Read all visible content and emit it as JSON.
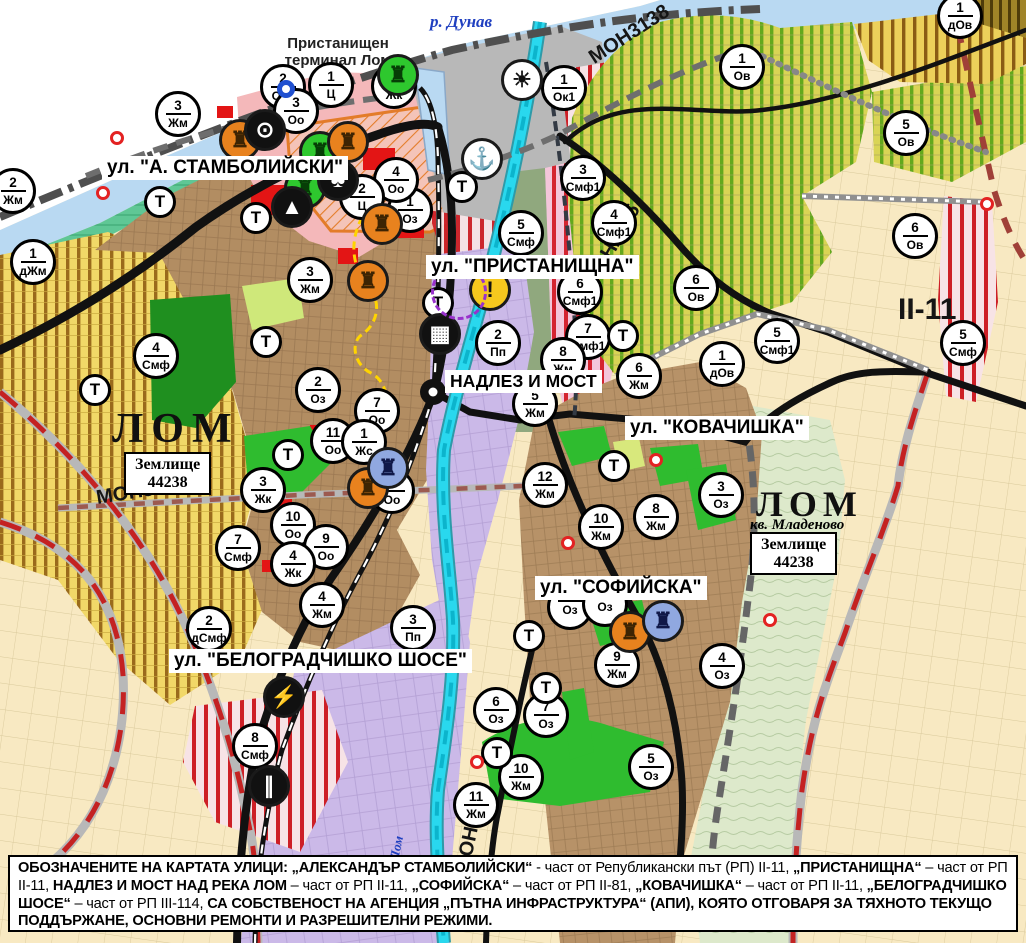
{
  "map": {
    "street_labels": [
      {
        "id": "stamboliyski",
        "text": "ул. \"А. СТАМБОЛИЙСКИ\""
      },
      {
        "id": "pristanishtna",
        "text": "ул. \"ПРИСТАНИЩНА\""
      },
      {
        "id": "nadlez",
        "text": "НАДЛЕЗ И МОСТ"
      },
      {
        "id": "kovachishka",
        "text": "ул. \"КОВАЧИШКА\""
      },
      {
        "id": "sofiyska",
        "text": "ул. \"СОФИЙСКА\""
      },
      {
        "id": "belogradchishko",
        "text": "ул. \"БЕЛОГРАДЧИШКО ШОСЕ\""
      }
    ],
    "place_labels": {
      "terminal": "Пристанищен терминал Лом",
      "danube": "р. Дунав",
      "lom_river": "Лом",
      "lom_left": "ЛОМ",
      "lom_right": "ЛОМ",
      "kv_mladenovo": "кв. Младеново",
      "zemlishte_line1": "Землище",
      "zemlishte_line2": "44238"
    },
    "road_labels": {
      "mon3139": "МОН3139",
      "mon3138": "МОН3138",
      "mon2135": "МОН2135",
      "mon2136": "МОН2136",
      "ii11": "II-11"
    },
    "t_label": "Т",
    "markers": [
      {
        "x": 283,
        "y": 87,
        "n": "2",
        "c": "Ози"
      },
      {
        "x": 331,
        "y": 85,
        "n": "1",
        "c": "Ц"
      },
      {
        "x": 296,
        "y": 111,
        "n": "3",
        "c": "Оо"
      },
      {
        "x": 394,
        "y": 86,
        "n": "1",
        "c": "Жк"
      },
      {
        "x": 178,
        "y": 114,
        "n": "3",
        "c": "Жм"
      },
      {
        "x": 13,
        "y": 191,
        "n": "2",
        "c": "Жм"
      },
      {
        "x": 33,
        "y": 262,
        "n": "1",
        "c": "дЖм"
      },
      {
        "x": 960,
        "y": 16,
        "n": "1",
        "c": "дОв"
      },
      {
        "x": 742,
        "y": 67,
        "n": "1",
        "c": "Ов"
      },
      {
        "x": 906,
        "y": 133,
        "n": "5",
        "c": "Ов"
      },
      {
        "x": 564,
        "y": 88,
        "n": "1",
        "c": "Ок1"
      },
      {
        "x": 583,
        "y": 178,
        "n": "3",
        "c": "Смф1"
      },
      {
        "x": 521,
        "y": 233,
        "n": "5",
        "c": "Смф"
      },
      {
        "x": 614,
        "y": 223,
        "n": "4",
        "c": "Смф1"
      },
      {
        "x": 410,
        "y": 210,
        "n": "1",
        "c": "Оз"
      },
      {
        "x": 396,
        "y": 180,
        "n": "4",
        "c": "Оо"
      },
      {
        "x": 362,
        "y": 197,
        "n": "2",
        "c": "Ц"
      },
      {
        "x": 310,
        "y": 280,
        "n": "3",
        "c": "Жм"
      },
      {
        "x": 580,
        "y": 292,
        "n": "6",
        "c": "Смф1"
      },
      {
        "x": 588,
        "y": 337,
        "n": "7",
        "c": "Смф1"
      },
      {
        "x": 696,
        "y": 288,
        "n": "6",
        "c": "Ов"
      },
      {
        "x": 915,
        "y": 236,
        "n": "6",
        "c": "Ов"
      },
      {
        "x": 777,
        "y": 341,
        "n": "5",
        "c": "Смф1"
      },
      {
        "x": 722,
        "y": 364,
        "n": "1",
        "c": "дОв"
      },
      {
        "x": 563,
        "y": 360,
        "n": "8",
        "c": "Жм"
      },
      {
        "x": 535,
        "y": 404,
        "n": "5",
        "c": "Жм"
      },
      {
        "x": 639,
        "y": 376,
        "n": "6",
        "c": "Жм"
      },
      {
        "x": 545,
        "y": 485,
        "n": "12",
        "c": "Жм"
      },
      {
        "x": 601,
        "y": 527,
        "n": "10",
        "c": "Жм"
      },
      {
        "x": 656,
        "y": 517,
        "n": "8",
        "c": "Жм"
      },
      {
        "x": 721,
        "y": 495,
        "n": "3",
        "c": "Оз"
      },
      {
        "x": 318,
        "y": 390,
        "n": "2",
        "c": "Оз"
      },
      {
        "x": 377,
        "y": 411,
        "n": "7",
        "c": "Оо"
      },
      {
        "x": 333,
        "y": 441,
        "n": "11",
        "c": "Оо"
      },
      {
        "x": 364,
        "y": 442,
        "n": "1",
        "c": "Жс"
      },
      {
        "x": 263,
        "y": 490,
        "n": "3",
        "c": "Жк"
      },
      {
        "x": 392,
        "y": 491,
        "n": "8",
        "c": "Оо"
      },
      {
        "x": 293,
        "y": 525,
        "n": "10",
        "c": "Оо"
      },
      {
        "x": 326,
        "y": 547,
        "n": "9",
        "c": "Оо"
      },
      {
        "x": 293,
        "y": 564,
        "n": "4",
        "c": "Жк"
      },
      {
        "x": 238,
        "y": 548,
        "n": "7",
        "c": "Смф"
      },
      {
        "x": 156,
        "y": 356,
        "n": "4",
        "c": "Смф"
      },
      {
        "x": 209,
        "y": 629,
        "n": "2",
        "c": "дСмф"
      },
      {
        "x": 322,
        "y": 605,
        "n": "4",
        "c": "Жм"
      },
      {
        "x": 413,
        "y": 628,
        "n": "3",
        "c": "Пп"
      },
      {
        "x": 255,
        "y": 746,
        "n": "8",
        "c": "Смф"
      },
      {
        "x": 496,
        "y": 710,
        "n": "6",
        "c": "Оз"
      },
      {
        "x": 546,
        "y": 715,
        "n": "7",
        "c": "Оз"
      },
      {
        "x": 476,
        "y": 805,
        "n": "11",
        "c": "Жм"
      },
      {
        "x": 521,
        "y": 777,
        "n": "10",
        "c": "Жм"
      },
      {
        "x": 651,
        "y": 767,
        "n": "5",
        "c": "Оз"
      },
      {
        "x": 617,
        "y": 665,
        "n": "9",
        "c": "Жм"
      },
      {
        "x": 722,
        "y": 666,
        "n": "4",
        "c": "Оз"
      },
      {
        "x": 498,
        "y": 343,
        "n": "2",
        "c": "Пп"
      },
      {
        "x": 963,
        "y": 343,
        "n": "5",
        "c": "Смф"
      },
      {
        "x": 570,
        "y": 607,
        "n": "",
        "c": "Оз"
      },
      {
        "x": 605,
        "y": 604,
        "n": "",
        "c": "Оз"
      }
    ],
    "t_markers": [
      [
        160,
        202
      ],
      [
        256,
        218
      ],
      [
        462,
        187
      ],
      [
        438,
        303
      ],
      [
        266,
        342
      ],
      [
        95,
        390
      ],
      [
        288,
        455
      ],
      [
        623,
        336
      ],
      [
        614,
        466
      ],
      [
        529,
        636
      ],
      [
        546,
        688
      ],
      [
        497,
        753
      ]
    ],
    "icon_defs": {
      "monument": {
        "glyph": "♜"
      },
      "ring-arrow": {
        "glyph": "⊙"
      },
      "trefoil": {
        "glyph": "♣"
      },
      "cave": {
        "glyph": "▲"
      },
      "truck": {
        "glyph": "▦"
      },
      "lightning": {
        "glyph": "⚡"
      },
      "rail-crossing": {
        "glyph": "∥"
      },
      "anchor": {
        "glyph": "⚓"
      },
      "sun": {
        "glyph": "☀"
      },
      "warning": {
        "glyph": "!"
      },
      "dashed-circle": {
        "glyph": ""
      },
      "ring": {
        "glyph": ""
      }
    },
    "icon_markers": [
      {
        "x": 398,
        "y": 75,
        "type": "monument",
        "bg": "#2ec82e",
        "fg": "#063e06"
      },
      {
        "x": 320,
        "y": 152,
        "type": "monument",
        "bg": "#2ec82e",
        "fg": "#063e06"
      },
      {
        "x": 305,
        "y": 188,
        "type": "monument",
        "bg": "#2ec82e",
        "fg": "#063e06"
      },
      {
        "x": 240,
        "y": 140,
        "type": "monument",
        "bg": "#e8821e",
        "fg": "#3d2403"
      },
      {
        "x": 348,
        "y": 142,
        "type": "monument",
        "bg": "#e8821e",
        "fg": "#3d2403"
      },
      {
        "x": 368,
        "y": 281,
        "type": "monument",
        "bg": "#e8821e",
        "fg": "#3d2403"
      },
      {
        "x": 382,
        "y": 224,
        "type": "monument",
        "bg": "#e8821e",
        "fg": "#3d2403"
      },
      {
        "x": 368,
        "y": 488,
        "type": "monument",
        "bg": "#e8821e",
        "fg": "#3d2403"
      },
      {
        "x": 630,
        "y": 632,
        "type": "monument",
        "bg": "#e8821e",
        "fg": "#3d2403"
      },
      {
        "x": 388,
        "y": 468,
        "type": "monument",
        "bg": "#90a8e0",
        "fg": "#101848"
      },
      {
        "x": 663,
        "y": 621,
        "type": "monument",
        "bg": "#90a8e0",
        "fg": "#101848"
      },
      {
        "x": 265,
        "y": 130,
        "type": "ring-arrow",
        "bg": "#111111",
        "fg": "#ffffff"
      },
      {
        "x": 338,
        "y": 180,
        "type": "trefoil",
        "bg": "#111111",
        "fg": "#ffffff"
      },
      {
        "x": 292,
        "y": 207,
        "type": "cave",
        "bg": "#111111",
        "fg": "#ffffff"
      },
      {
        "x": 440,
        "y": 334,
        "type": "truck",
        "bg": "#111111",
        "fg": "#ffffff"
      },
      {
        "x": 284,
        "y": 697,
        "type": "lightning",
        "bg": "#111111",
        "fg": "#ffffff"
      },
      {
        "x": 269,
        "y": 786,
        "type": "rail-crossing",
        "bg": "#111111",
        "fg": "#ffffff"
      },
      {
        "x": 482,
        "y": 159,
        "type": "anchor",
        "bg": "#ffffff",
        "fg": "#111111"
      },
      {
        "x": 522,
        "y": 80,
        "type": "sun",
        "bg": "#ffffff",
        "fg": "#111111"
      },
      {
        "x": 490,
        "y": 290,
        "type": "warning",
        "bg": "#f6c81e",
        "fg": "#111111"
      },
      {
        "x": 459,
        "y": 292,
        "type": "dashed-circle",
        "bg": "transparent",
        "fg": "#9932cc",
        "size": 56,
        "border": "3px dashed #9932cc"
      },
      {
        "x": 286,
        "y": 89,
        "type": "ring",
        "bg": "#ffffff",
        "fg": "#2050d0",
        "size": 18,
        "border": "5px solid #2050d0"
      }
    ],
    "dots": [
      [
        117,
        138
      ],
      [
        103,
        193
      ],
      [
        656,
        460
      ],
      [
        568,
        543
      ],
      [
        477,
        762
      ],
      [
        770,
        620
      ],
      [
        987,
        204
      ]
    ]
  },
  "legend": {
    "segments": [
      {
        "t": "ОБОЗНАЧЕНИТЕ НА КАРТАТА УЛИЦИ: „АЛЕКСАНДЪР СТАМБОЛИЙСКИ“",
        "b": true
      },
      {
        "t": " - част от Републикански път (РП) II-11, ",
        "b": false
      },
      {
        "t": "„ПРИСТАНИЩНА“",
        "b": true
      },
      {
        "t": " – част от РП II-11, ",
        "b": false
      },
      {
        "t": "НАДЛЕЗ И МОСТ НАД РЕКА ЛОМ",
        "b": true
      },
      {
        "t": " – част от РП II-11, ",
        "b": false
      },
      {
        "t": "„СОФИЙСКА“",
        "b": true
      },
      {
        "t": " – част от РП II-81, ",
        "b": false
      },
      {
        "t": "„КОВАЧИШКА“",
        "b": true
      },
      {
        "t": " – част от РП II-11, ",
        "b": false
      },
      {
        "t": "„БЕЛОГРАДЧИШКО ШОСЕ“",
        "b": true
      },
      {
        "t": " – част от РП III-114, ",
        "b": false
      },
      {
        "t": "СА СОБСТВЕНОСТ НА АГЕНЦИЯ „ПЪТНА ИНФРАСТРУКТУРА“ (АПИ), КОЯТО ОТГОВАРЯ ЗА ТЯХНОТО ТЕКУЩО ПОДДЪРЖАНЕ, ОСНОВНИ РЕМОНТИ И РАЗРЕШИТЕЛНИ РЕЖИМИ.",
        "b": true
      }
    ]
  }
}
